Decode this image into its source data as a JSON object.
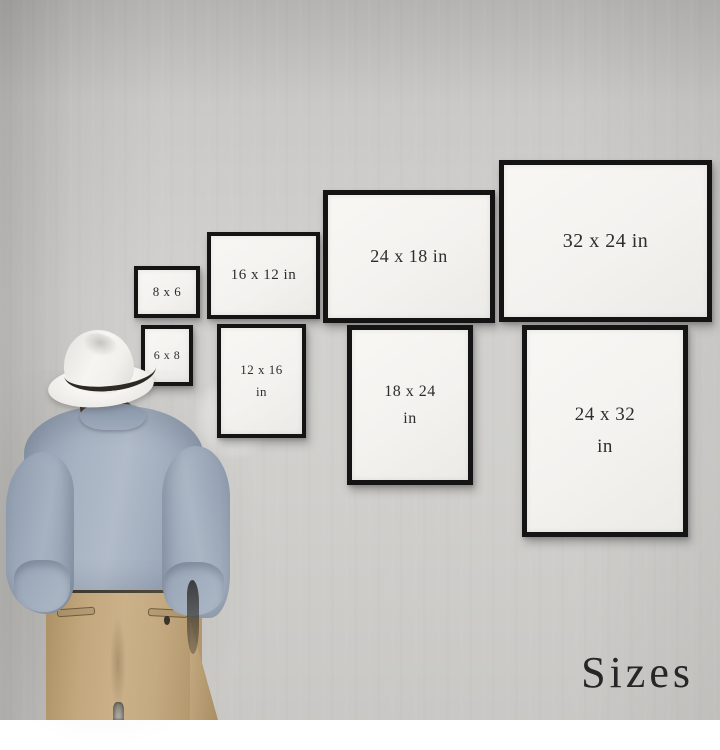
{
  "caption": {
    "text": "Sizes"
  },
  "frames": [
    {
      "name": "frame-8x6",
      "orientation": "landscape",
      "line1": "8 x 6"
    },
    {
      "name": "frame-16x12",
      "orientation": "landscape",
      "line1": "16 x 12 in"
    },
    {
      "name": "frame-24x18",
      "orientation": "landscape",
      "line1": "24 x 18 in"
    },
    {
      "name": "frame-32x24",
      "orientation": "landscape",
      "line1": "32 x 24 in"
    },
    {
      "name": "frame-6x8",
      "orientation": "portrait",
      "line1": "6 x 8"
    },
    {
      "name": "frame-12x16",
      "orientation": "portrait",
      "line1": "12 x 16",
      "line2": "in"
    },
    {
      "name": "frame-18x24",
      "orientation": "portrait",
      "line1": "18 x 24",
      "line2": "in"
    },
    {
      "name": "frame-24x32",
      "orientation": "portrait",
      "line1": "24 x 32",
      "line2": "in"
    }
  ],
  "colors": {
    "frame_border": "#141414",
    "frame_face": "#f3f2ef",
    "label_text": "#2d2d2d",
    "caption_text": "#262626",
    "hat": "#eceae6",
    "hat_band": "#2d2a24",
    "hair": "#3a2a1e",
    "shirt": "#a2aebe",
    "pants": "#c3a87e"
  }
}
